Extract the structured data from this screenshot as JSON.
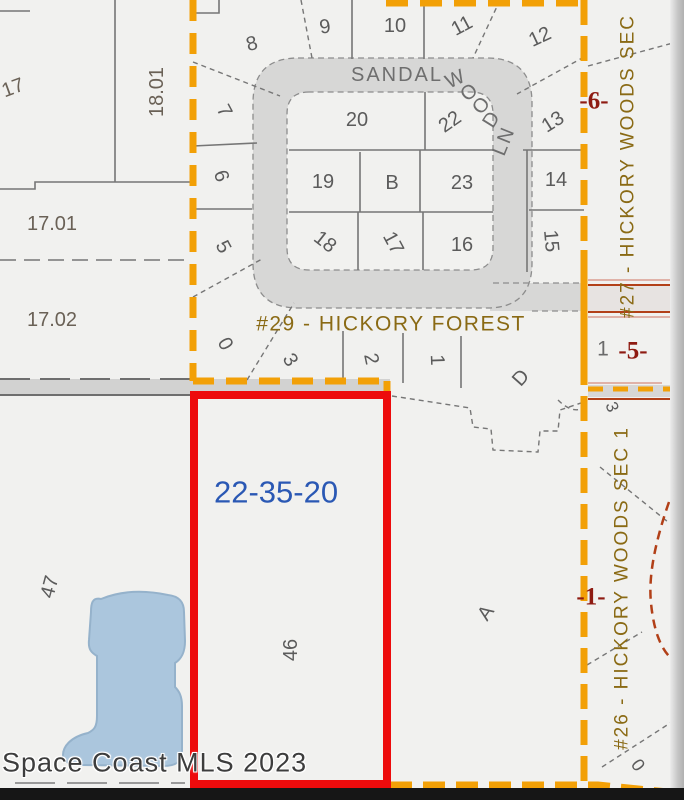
{
  "map": {
    "watermark": "Space Coast MLS 2023",
    "parcel_id": "22-35-20",
    "street": {
      "name": "SANDALWOOD LN",
      "seg1": "SANDAL",
      "seg2": "W",
      "seg3": "O",
      "seg4": "O",
      "seg5": "D",
      "seg6": "LN"
    },
    "subdivisions": {
      "hickory_forest": "#29 - HICKORY FOREST",
      "hickory_woods_sec": "#27 - HICKORY WOODS SEC",
      "hickory_woods_sec1": "#26 - HICKORY WOODS SEC 1"
    },
    "markers": {
      "m6": "-6-",
      "m5": "-5-",
      "m5_prefix": "1",
      "m1": "-1-"
    },
    "lots": {
      "n8": "8",
      "n9": "9",
      "n10": "10",
      "n11": "11",
      "n12": "12",
      "n13": "13",
      "n14": "14",
      "n15": "15",
      "n16": "16",
      "n17": "17",
      "n18": "18",
      "n19": "19",
      "n20": "20",
      "n22": "22",
      "n23": "23",
      "b": "B",
      "n7": "7",
      "n6": "6",
      "n5": "5",
      "n0": "0",
      "n3": "3",
      "n2": "2",
      "n1": "1",
      "d": "D",
      "a": "A",
      "n46": "46",
      "n47": "47",
      "r3": "3",
      "r0": "0"
    },
    "parcels": {
      "p17": "17",
      "p18_01": "18.01",
      "p17_01": "17.01",
      "p17_02": "17.02"
    },
    "colors": {
      "boundary_orange": "#F2A007",
      "highlight_red": "#ED0B0C",
      "parcel_id_blue": "#2A58B4",
      "marker_red": "#8E1B12",
      "subdivision_brown": "#8A6A14",
      "water": "#ABC6DD",
      "road": "#D7D7D6"
    }
  }
}
